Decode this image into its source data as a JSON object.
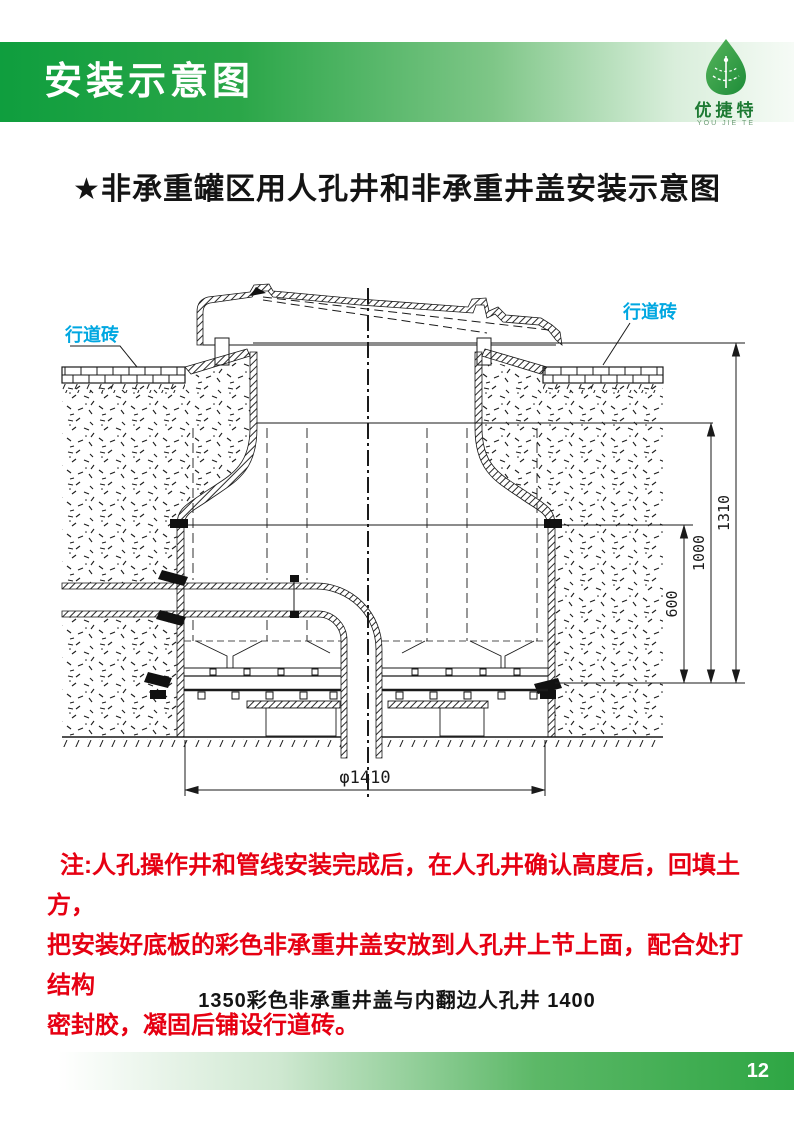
{
  "header": {
    "title": "安装示意图"
  },
  "logo": {
    "name": "优捷特",
    "sub": "YOU JIE TE"
  },
  "main": {
    "title": "★非承重罐区用人孔井和非承重井盖安装示意图"
  },
  "diagram": {
    "label_paver_left": "行道砖",
    "label_paver_right": "行道砖",
    "dims": {
      "total_height": "1310",
      "mid_height": "1000",
      "lower_height": "600",
      "diameter": "φ1410"
    }
  },
  "note": {
    "lines": [
      "注:人孔操作井和管线安装完成后，在人孔井确认高度后，回填土方，",
      "把安装好底板的彩色非承重井盖安放到人孔井上节上面，配合处打结构",
      "密封胶，凝固后铺设行道砖。"
    ]
  },
  "caption": "1350彩色非承重井盖与内翻边人孔井 1400",
  "footer": {
    "page": "12"
  },
  "colors": {
    "header_green": "#0f9e3e",
    "footer_green": "#2ea644",
    "note_red": "#e60012",
    "label_cyan": "#00a7e1",
    "logo_green": "#2f9e41",
    "line_black": "#1a1a1a"
  }
}
